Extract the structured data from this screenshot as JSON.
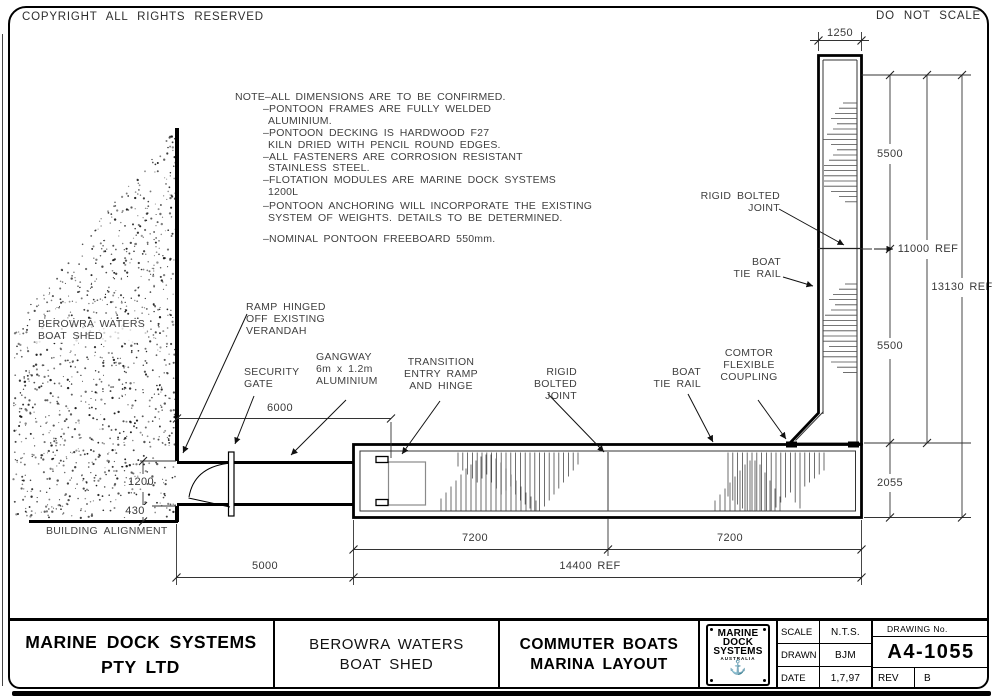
{
  "header": {
    "copyright": "COPYRIGHT ALL RIGHTS RESERVED",
    "do_not_scale": "DO NOT SCALE"
  },
  "notes": {
    "lines": [
      {
        "text": "NOTE–ALL DIMENSIONS ARE TO BE CONFIRMED.",
        "indent": 0
      },
      {
        "text": "–PONTOON FRAMES ARE FULLY WELDED",
        "indent": 1
      },
      {
        "text": "ALUMINIUM.",
        "indent": 2
      },
      {
        "text": "–PONTOON DECKING IS HARDWOOD F27",
        "indent": 1
      },
      {
        "text": "KILN DRIED WITH PENCIL ROUND EDGES.",
        "indent": 2
      },
      {
        "text": "–ALL FASTENERS ARE CORROSION RESISTANT",
        "indent": 1
      },
      {
        "text": "STAINLESS STEEL.",
        "indent": 2
      },
      {
        "text": "–FLOTATION MODULES ARE MARINE DOCK SYSTEMS",
        "indent": 1
      },
      {
        "text": "1200L",
        "indent": 2
      },
      {
        "text": "–PONTOON ANCHORING WILL INCORPORATE THE EXISTING",
        "indent": 1,
        "gap": "s"
      },
      {
        "text": "SYSTEM OF WEIGHTS. DETAILS TO BE DETERMINED.",
        "indent": 2
      },
      {
        "text": "–NOMINAL PONTOON FREEBOARD 550mm.",
        "indent": 1,
        "gap": "l"
      }
    ]
  },
  "labels": {
    "ramp_hinged": "RAMP HINGED\nOFF EXISTING\nVERANDAH",
    "security_gate": "SECURITY\nGATE",
    "gangway": "GANGWAY\n6m x 1.2m\nALUMINIUM",
    "transition": "TRANSITION\nENTRY RAMP\nAND HINGE",
    "rigid_joint_h": "RIGID BOLTED\nJOINT",
    "rigid_joint_v": "RIGID BOLTED\nJOINT",
    "boat_tie_h": "BOAT\nTIE RAIL",
    "boat_tie_v": "BOAT\nTIE RAIL",
    "comtor": "COMTOR\nFLEXIBLE\nCOUPLING"
  },
  "site": {
    "shed": "BEROWRA WATERS\nBOAT SHED",
    "building_alignment": "BUILDING ALIGNMENT"
  },
  "dimensions": {
    "d1250": "1250",
    "d5500_top": "5500",
    "d11000": "11000 REF",
    "d13130": "13130 REF",
    "d5500_bottom": "5500",
    "d2055": "2055",
    "d6000": "6000",
    "d1200": "1200",
    "d430": "430",
    "d7200_a": "7200",
    "d7200_b": "7200",
    "d5000": "5000",
    "d14400": "14400 REF"
  },
  "title_block": {
    "company": "MARINE DOCK SYSTEMS\nPTY LTD",
    "project": "BEROWRA WATERS\nBOAT SHED",
    "drawing_title": "COMMUTER BOATS\nMARINA LAYOUT",
    "logo": {
      "line1": "MARINE",
      "line2": "DOCK",
      "line3": "SYSTEMS",
      "line4": "AUSTRALIA",
      "anchor_icon": "⚓"
    },
    "scale_label": "SCALE",
    "scale_value": "N.T.S.",
    "drawn_label": "DRAWN",
    "drawn_value": "BJM",
    "date_label": "DATE",
    "date_value": "1,7,97",
    "drawing_no_label": "DRAWING No.",
    "drawing_no": "A4-1055",
    "rev_label": "REV",
    "rev_value": "B"
  }
}
